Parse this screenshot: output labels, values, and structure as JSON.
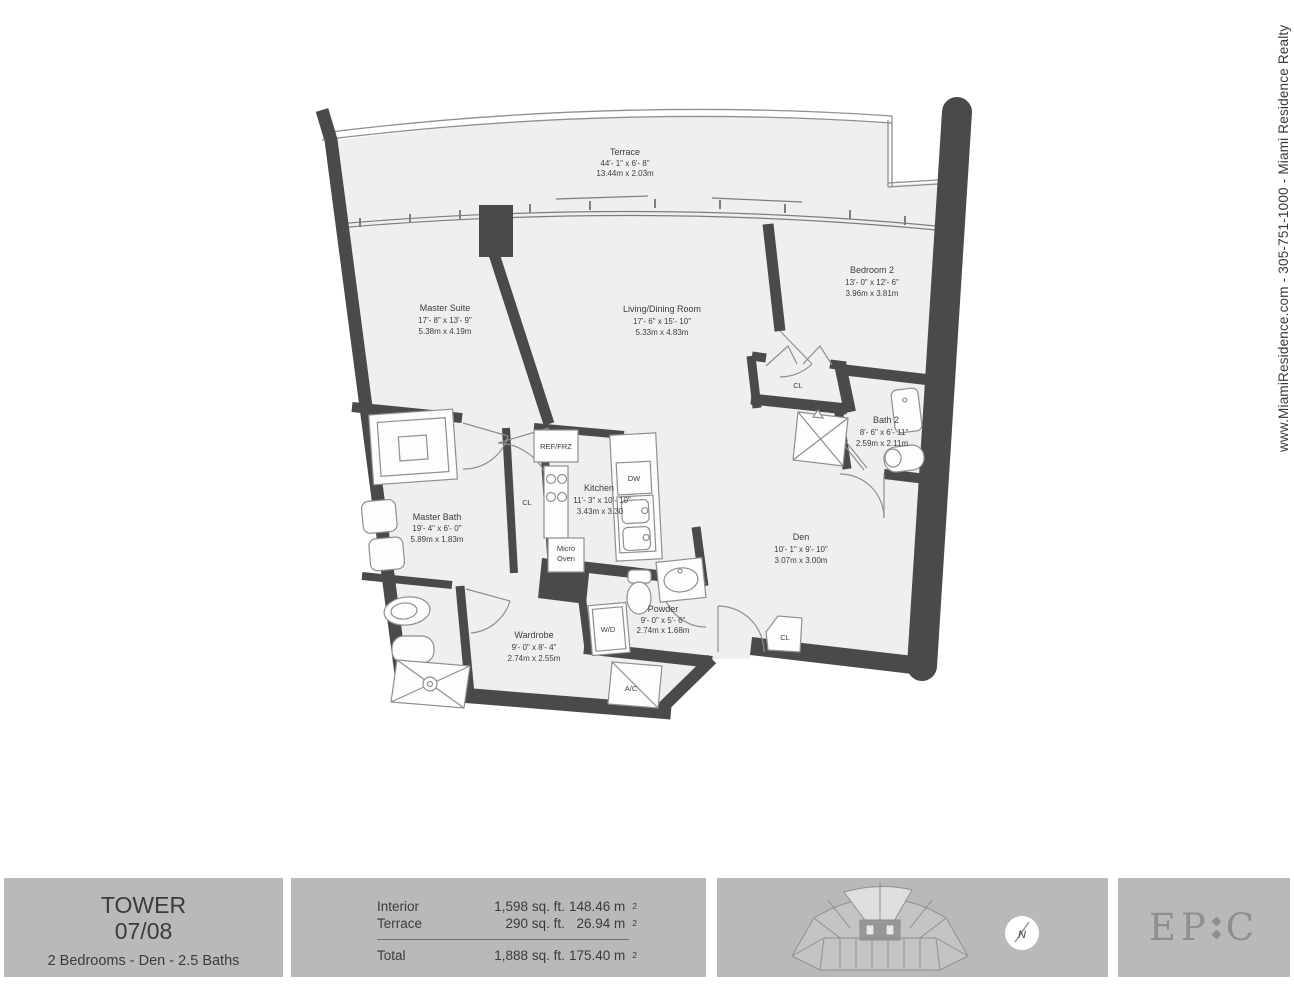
{
  "contact_strip": "www.MiamiResidence.com  -  305-751-1000  -  Miami Residence Realty",
  "colors": {
    "wall": "#4a4a4d",
    "floor": "#f0efee",
    "line": "#8f8f8f",
    "footer_box": "#b9b9b9",
    "text": "#3d3d3d",
    "logo_gray": "#8f8f8f"
  },
  "plan": {
    "rooms": {
      "terrace": {
        "name": "Terrace",
        "ft": "44'- 1\" x 6'- 8\"",
        "m": "13.44m x 2.03m"
      },
      "master_suite": {
        "name": "Master Suite",
        "ft": "17'- 8\" x 13'- 9\"",
        "m": "5.38m x 4.19m"
      },
      "living_dining": {
        "name": "Living/Dining Room",
        "ft": "17'- 6\" x 15'- 10\"",
        "m": "5.33m x 4.83m"
      },
      "bedroom2": {
        "name": "Bedroom 2",
        "ft": "13'- 0\" x 12'- 6\"",
        "m": "3.96m x 3.81m"
      },
      "bath2": {
        "name": "Bath 2",
        "ft": "8'- 6\" x 6'- 11\"",
        "m": "2.59m x 2.11m"
      },
      "kitchen": {
        "name": "Kitchen",
        "ft": "11'- 3\" x 10'- 10\"",
        "m": "3.43m x 3.30"
      },
      "den": {
        "name": "Den",
        "ft": "10'- 1\" x 9'- 10\"",
        "m": "3.07m x 3.00m"
      },
      "master_bath": {
        "name": "Master Bath",
        "ft": "19'- 4\" x 6'- 0\"",
        "m": "5.89m x 1.83m"
      },
      "wardrobe": {
        "name": "Wardrobe",
        "ft": "9'- 0\" x 8'- 4\"",
        "m": "2.74m x 2.55m"
      },
      "powder": {
        "name": "Powder",
        "ft": "9'- 0\" x 5'- 6\"",
        "m": "2.74m x 1.68m"
      }
    },
    "labels": {
      "ref_frz": "REF/FRZ",
      "cl": "CL",
      "micro1": "Micro",
      "micro2": "Oven",
      "dw": "DW",
      "wd": "W/D",
      "ac": "A/C"
    }
  },
  "footer": {
    "tower": {
      "line1": "TOWER",
      "line2": "07/08",
      "subtitle": "2 Bedrooms - Den - 2.5 Baths"
    },
    "stats": {
      "rows": [
        {
          "label": "Interior",
          "sqft": "1,598 sq. ft.",
          "sqm": "148.46 m",
          "sup": "2"
        },
        {
          "label": "Terrace",
          "sqft": "290 sq. ft.",
          "sqm": "26.94 m",
          "sup": "2"
        },
        {
          "label": "Total",
          "sqft": "1,888 sq. ft.",
          "sqm": "175.40 m",
          "sup": "2"
        }
      ]
    },
    "compass": {
      "letter": "N"
    },
    "logo": {
      "part1": "EP",
      "part2": "C"
    }
  }
}
